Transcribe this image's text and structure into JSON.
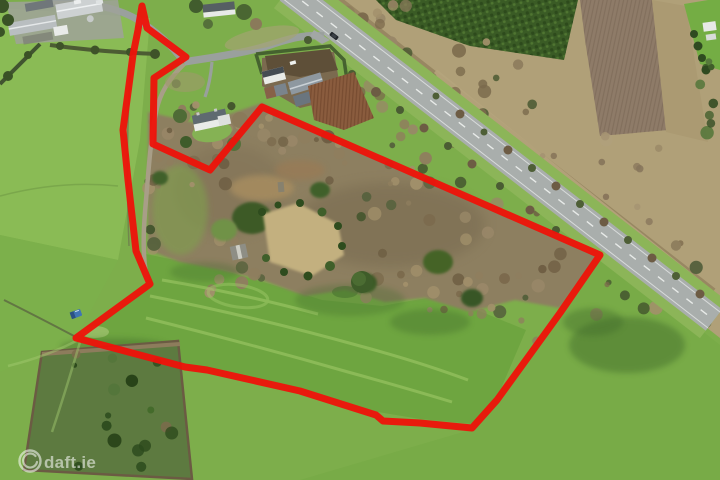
{
  "watermark": {
    "text": "daft.ie",
    "logo_icon": "daft-circle-logo",
    "color": "#ffffff",
    "opacity": 0.55
  },
  "boundary": {
    "color": "#ee1209",
    "stroke_width": 7,
    "points": "142,6 147,28 186,57 154,78 153,144 210,170 262,107 600,255 560,313 497,400 472,428 420,423 383,421 376,415 300,391 207,370 185,367 76,338 150,284 136,251 128,180 123,130 133,55 138,30"
  },
  "colors": {
    "pasture": "#7dae4b",
    "pasture_light": "#8cbd57",
    "pasture_dark": "#6ea540",
    "road_surface": "#a9aeac",
    "road_verge": "#8cb558",
    "woodland_brown": "#8d7f61",
    "conifer_green": "#3a5b25",
    "plough_brown": "#8a5c3e",
    "scrub_tan": "#b0a078",
    "boundary_red": "#ee1209"
  },
  "scene": {
    "type": "aerial-drone-photo",
    "subject": "land parcel outlined in red beside a main road",
    "features": [
      "main road",
      "side road junction",
      "access lane",
      "farm sheds",
      "detached houses",
      "farmstead with sheds",
      "ploughed field",
      "conifer plantation",
      "scrub woodland",
      "walled garden ruin",
      "pasture fields",
      "fenced copse",
      "blue vehicle in field",
      "dark car on road"
    ]
  }
}
